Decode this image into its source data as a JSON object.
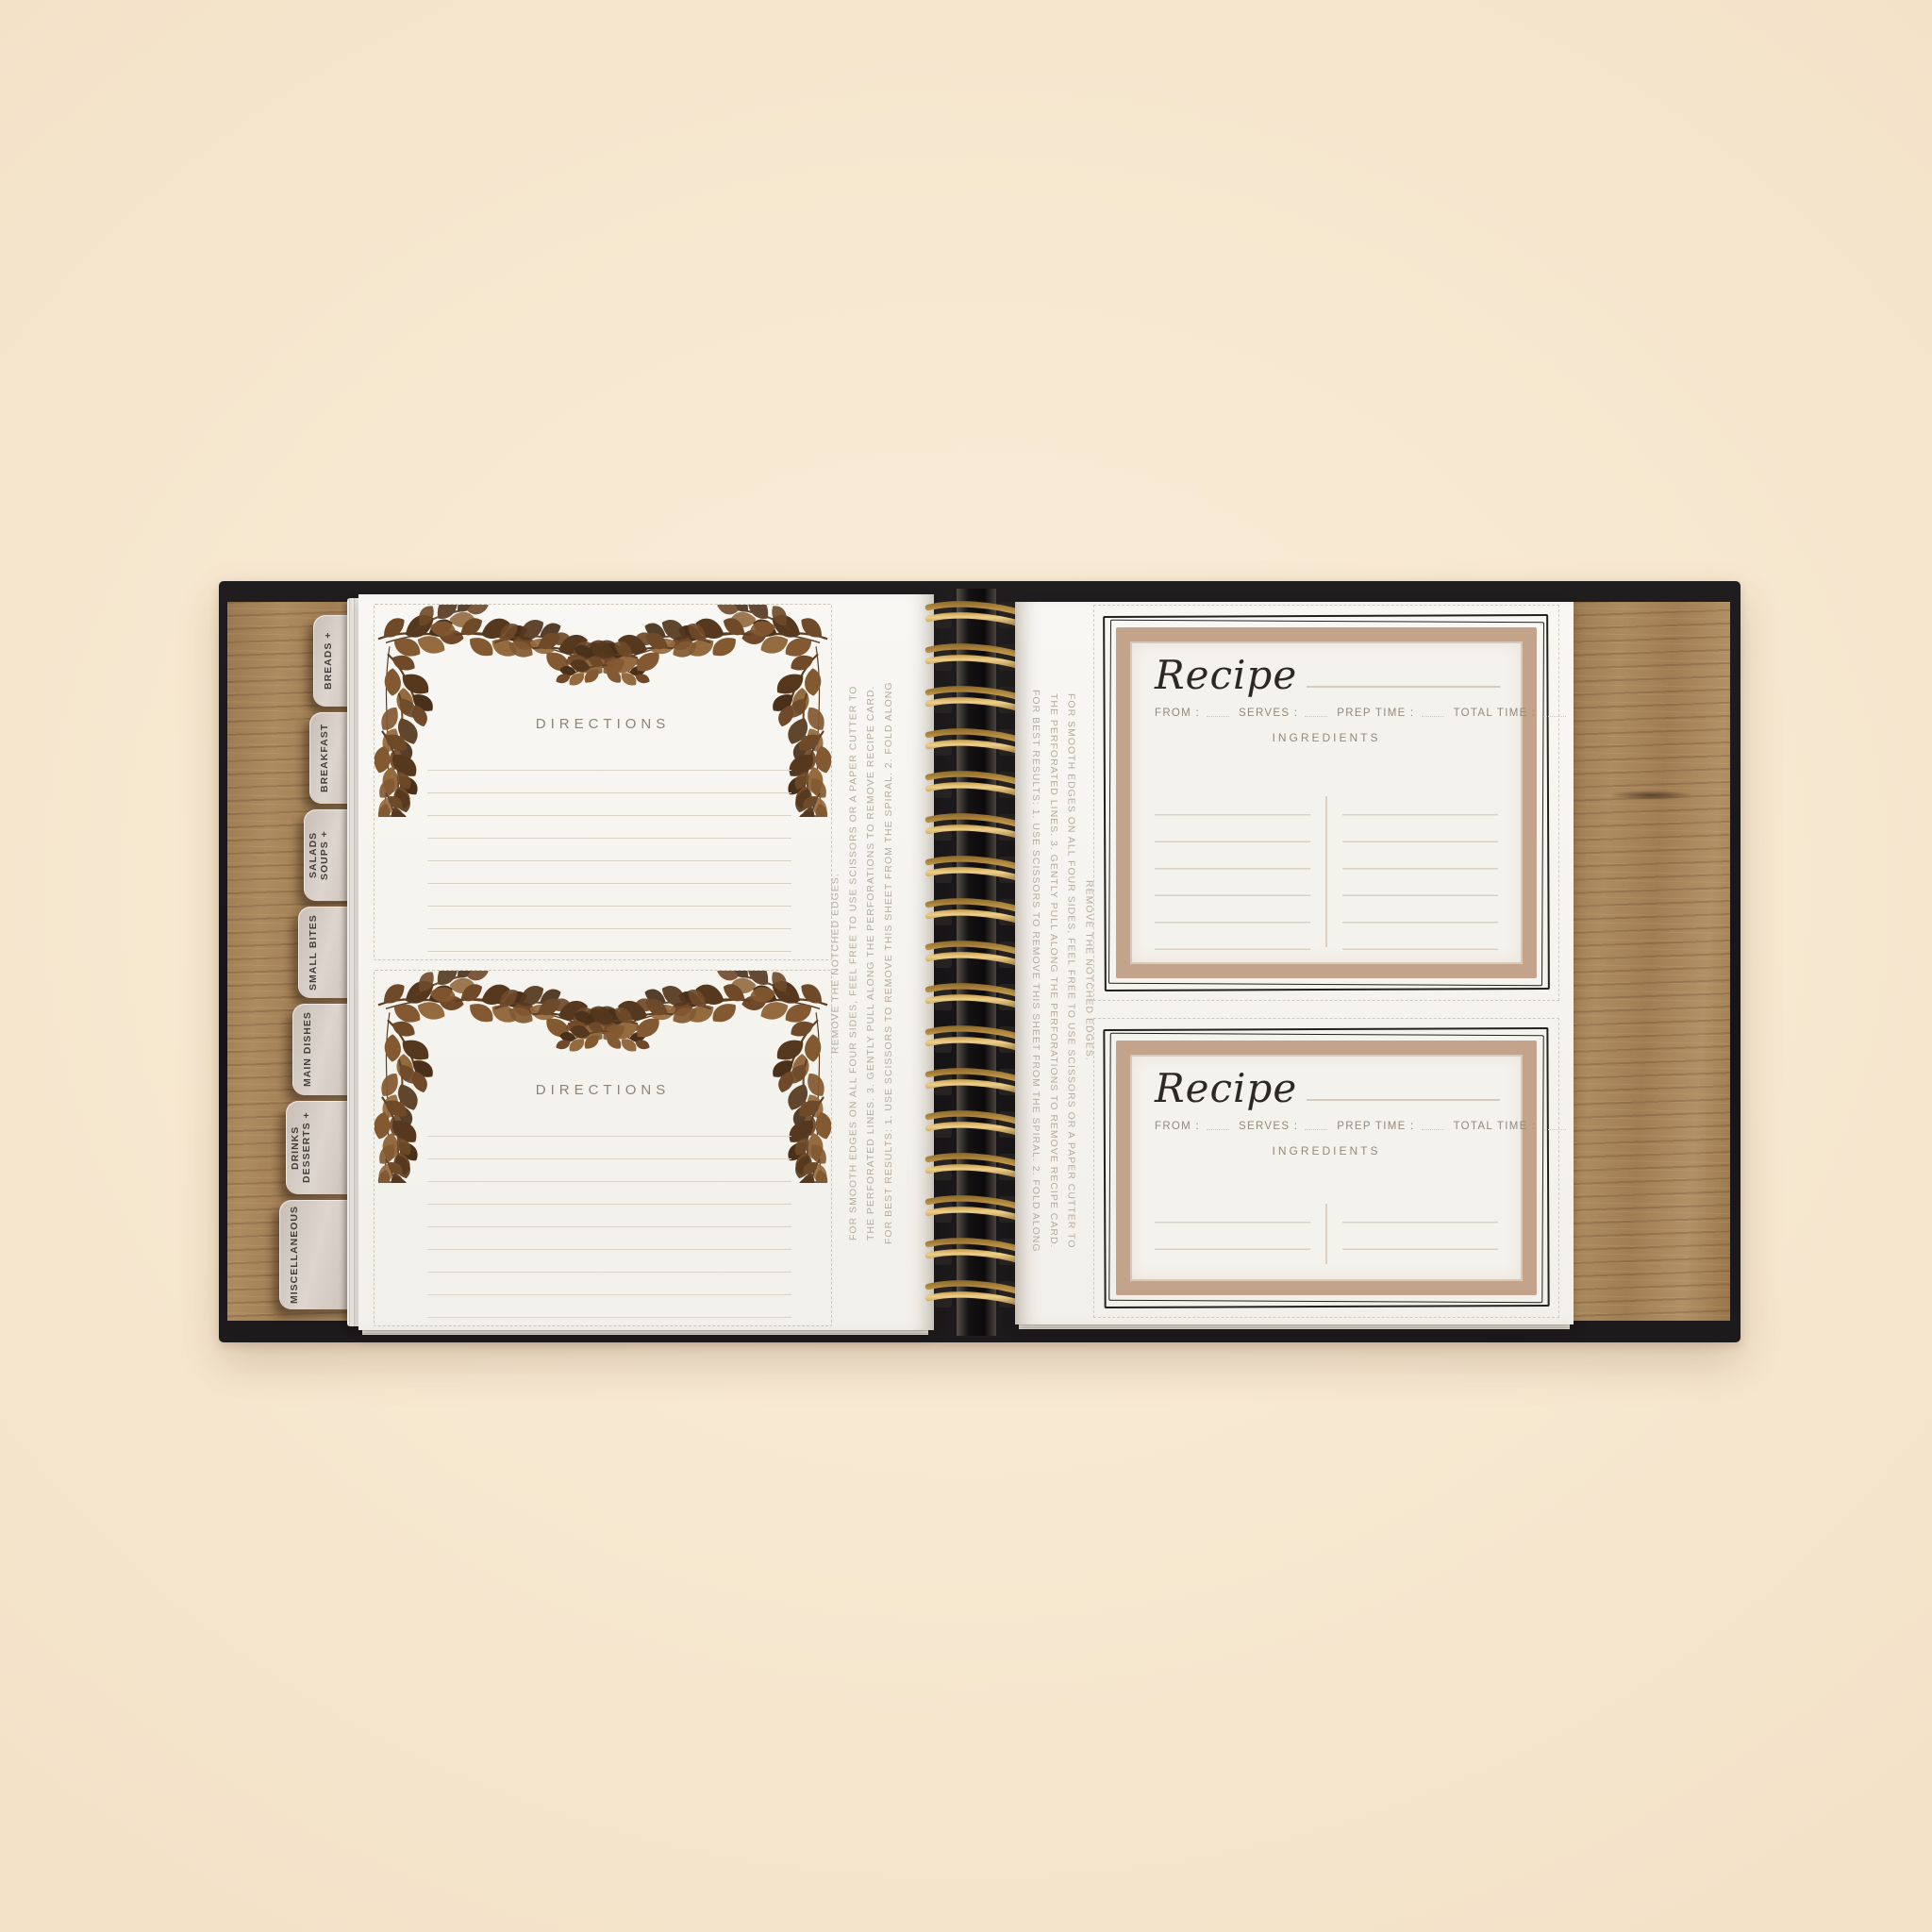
{
  "colors": {
    "background": "#f8e9d2",
    "cover_black": "#1a1719",
    "wood_brown": "#a5815a",
    "page_white": "#f6f4ef",
    "tab_taupe": "#d5ccc5",
    "wire_gold": "#c49a4a",
    "card_frame_tan": "#c3a389",
    "garland_brown": "#6b4929",
    "ink_black": "#2c2823",
    "muted_label_gray": "#93897c",
    "ruled_line": "#d8d1c4"
  },
  "tabs": [
    {
      "label": "BREADS +"
    },
    {
      "label": "BREAKFAST"
    },
    {
      "label": "SOUPS + SALADS"
    },
    {
      "label": "SMALL BITES"
    },
    {
      "label": "MAIN DISHES"
    },
    {
      "label": "DESSERTS + DRINKS"
    },
    {
      "label": "MISCELLANEOUS"
    }
  ],
  "left_page": {
    "cards": [
      {
        "title": "DIRECTIONS"
      },
      {
        "title": "DIRECTIONS"
      }
    ],
    "edge_note": "FOR BEST RESULTS: 1. USE SCISSORS TO REMOVE THIS SHEET FROM THE SPIRAL. 2. FOLD ALONG THE PERFORATED LINES. 3. GENTLY PULL ALONG THE PERFORATIONS TO REMOVE RECIPE CARD. FOR SMOOTH EDGES ON ALL FOUR SIDES, FEEL FREE TO USE SCISSORS OR A PAPER CUTTER TO REMOVE THE NOTCHED EDGES."
  },
  "right_page": {
    "edge_note": "FOR BEST RESULTS: 1. USE SCISSORS TO REMOVE THIS SHEET FROM THE SPIRAL. 2. FOLD ALONG THE PERFORATED LINES. 3. GENTLY PULL ALONG THE PERFORATIONS TO REMOVE RECIPE CARD. FOR SMOOTH EDGES ON ALL FOUR SIDES, FEEL FREE TO USE SCISSORS OR A PAPER CUTTER TO REMOVE THE NOTCHED EDGES.",
    "cards": [
      {
        "title": "Recipe",
        "from_label": "FROM :",
        "serves_label": "SERVES :",
        "prep_time_label": "PREP TIME :",
        "total_time_label": "TOTAL TIME :",
        "ingredients_label": "INGREDIENTS"
      },
      {
        "title": "Recipe",
        "from_label": "FROM :",
        "serves_label": "SERVES :",
        "prep_time_label": "PREP TIME :",
        "total_time_label": "TOTAL TIME :",
        "ingredients_label": "INGREDIENTS"
      }
    ]
  }
}
